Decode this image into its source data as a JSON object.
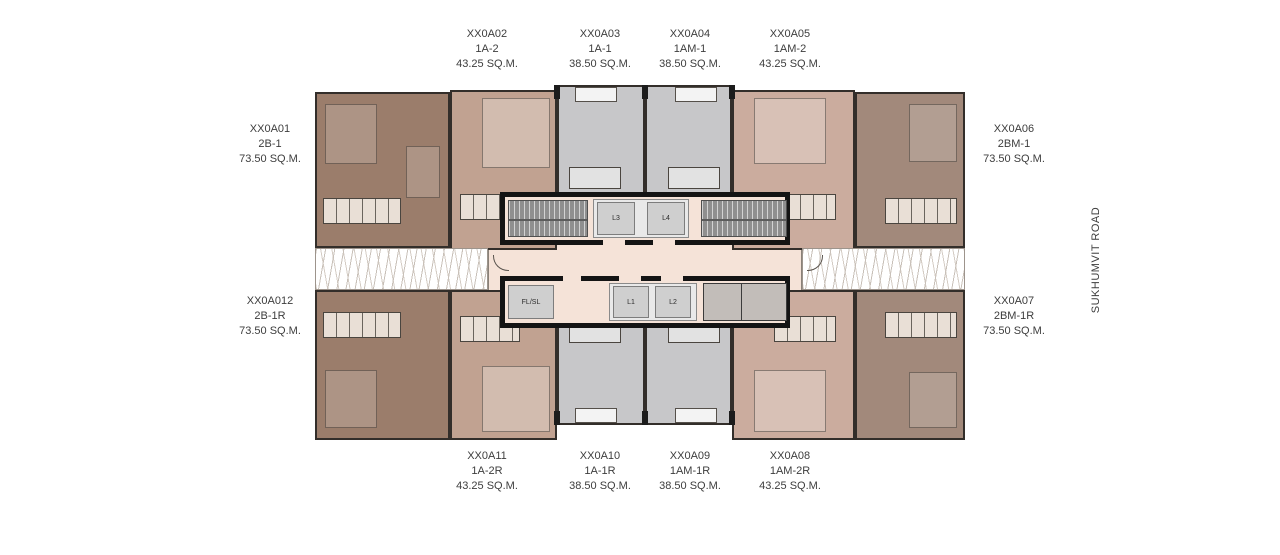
{
  "road": {
    "label": "SUKHUMVIT ROAD"
  },
  "units": [
    {
      "code": "XX0A01",
      "type": "2B-1",
      "area": "73.50 SQ.M."
    },
    {
      "code": "XX0A02",
      "type": "1A-2",
      "area": "43.25 SQ.M."
    },
    {
      "code": "XX0A03",
      "type": "1A-1",
      "area": "38.50 SQ.M."
    },
    {
      "code": "XX0A04",
      "type": "1AM-1",
      "area": "38.50 SQ.M."
    },
    {
      "code": "XX0A05",
      "type": "1AM-2",
      "area": "43.25 SQ.M."
    },
    {
      "code": "XX0A06",
      "type": "2BM-1",
      "area": "73.50 SQ.M."
    },
    {
      "code": "XX0A07",
      "type": "2BM-1R",
      "area": "73.50 SQ.M."
    },
    {
      "code": "XX0A08",
      "type": "1AM-2R",
      "area": "43.25 SQ.M."
    },
    {
      "code": "XX0A09",
      "type": "1AM-1R",
      "area": "38.50 SQ.M."
    },
    {
      "code": "XX0A10",
      "type": "1A-1R",
      "area": "38.50 SQ.M."
    },
    {
      "code": "XX0A11",
      "type": "1A-2R",
      "area": "43.25 SQ.M."
    },
    {
      "code": "XX0A012",
      "type": "2B-1R",
      "area": "73.50 SQ.M."
    }
  ],
  "core": {
    "lift_1": "L1",
    "lift_2": "L2",
    "lift_3": "L3",
    "lift_4": "L4",
    "fire_service_lift": "FL/SL"
  },
  "colors": {
    "unit_2b": "#9b7d6b",
    "unit_1a2": "#c1a291",
    "unit_1a1_1am1": "#c7c7c9",
    "unit_1am2": "#cbac9e",
    "unit_2bm": "#a2897b",
    "corridor": "#f5e3d8",
    "core_wall": "#141414",
    "balcony": "#ffffff"
  }
}
